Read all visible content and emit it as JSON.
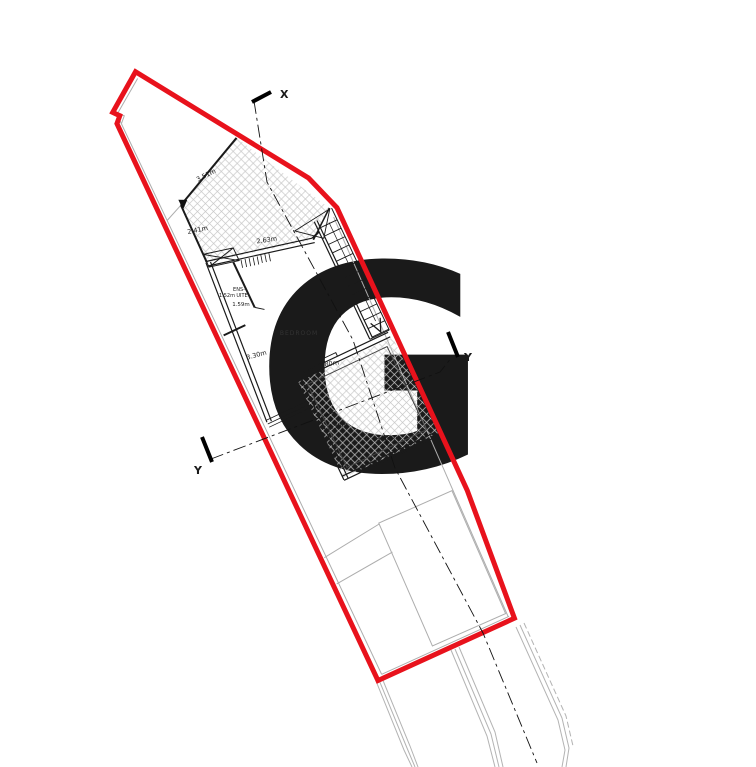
{
  "watermark": {
    "letter": "G",
    "color": "#F8CEC5"
  },
  "markers": {
    "x": "X",
    "y_left": "Y",
    "y_right": "Y"
  },
  "rooms": {
    "bedroom": "BEDROOM",
    "ensuite_line1": "ENS-",
    "ensuite_line2": "UITE"
  },
  "dimensions": {
    "d351": "3.51m",
    "d241": "2.41m",
    "d263": "2.63m",
    "d152": "1.52m",
    "d159": "1.59m",
    "d330a": "3.30m",
    "d580": "5.80m",
    "d330b": "3.30m",
    "d398": "3.98m"
  },
  "colors": {
    "boundary_red": "#E8121C",
    "watermark_pink": "#F8CEC5",
    "hatch_gray": "#C7C7C7",
    "wall_black": "#1A1A1A",
    "context_gray": "#ADADAD",
    "section_black": "#111111"
  }
}
